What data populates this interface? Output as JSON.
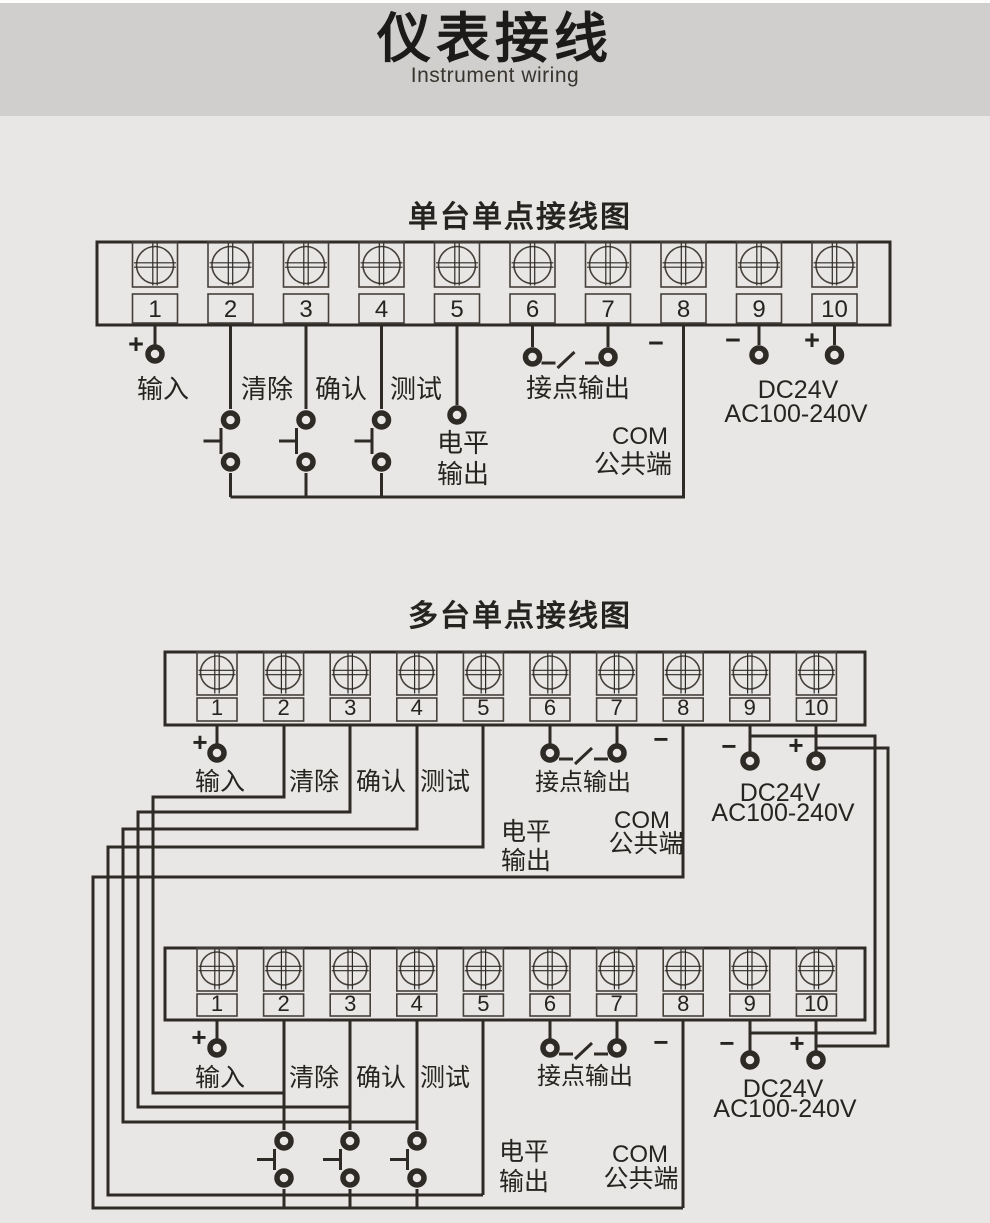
{
  "header": {
    "title": "仪表接线",
    "subtitle": "Instrument wiring"
  },
  "diagrams": [
    {
      "title": "单台单点接线图"
    },
    {
      "title": "多台单点接线图"
    }
  ],
  "terminal_numbers": [
    "1",
    "2",
    "3",
    "4",
    "5",
    "6",
    "7",
    "8",
    "9",
    "10"
  ],
  "labels": {
    "input": "输入",
    "clear": "清除",
    "confirm": "确认",
    "test": "测试",
    "contact_output": "接点输出",
    "level_1": "电平",
    "level_2": "输出",
    "com_1": "COM",
    "com_2": "公共端",
    "power_1": "DC24V",
    "power_2": "AC100-240V",
    "plus": "+",
    "minus": "−"
  },
  "colors": {
    "band_bg": "#d0cfcd",
    "page_bg": "#e8e7e5",
    "line": "#2e2a26",
    "thin_line": "#45403a",
    "text": "#262420"
  }
}
